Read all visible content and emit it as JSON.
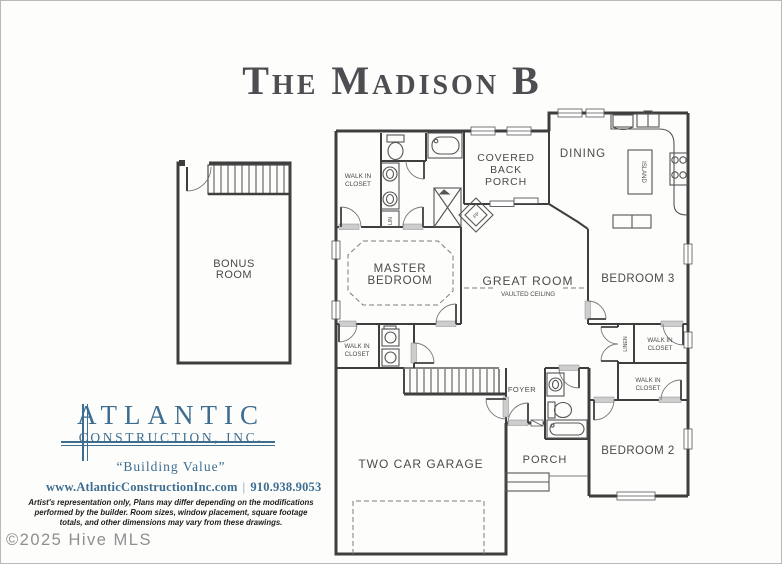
{
  "title": "The Madison B",
  "rooms": {
    "bonus_l1": "BONUS",
    "bonus_l2": "ROOM",
    "wic_master_top_l1": "WALK IN",
    "wic_master_top_l2": "CLOSET",
    "lin": "LIN",
    "covered_porch_l1": "COVERED",
    "covered_porch_l2": "BACK",
    "covered_porch_l3": "PORCH",
    "dining": "DINING",
    "island": "ISLAND",
    "fireplace": "FP",
    "master_l1": "MASTER",
    "master_l2": "BEDROOM",
    "great_room": "GREAT ROOM",
    "vaulted": "VAULTED CEILING",
    "bedroom3": "BEDROOM 3",
    "linen": "LINEN",
    "wic_bed3_l1": "WALK IN",
    "wic_bed3_l2": "CLOSET",
    "wic_master_bot_l1": "WALK IN",
    "wic_master_bot_l2": "CLOSET",
    "wic_bed2_l1": "WALK IN",
    "wic_bed2_l2": "CLOSET",
    "foyer": "FOYER",
    "bedroom2": "BEDROOM 2",
    "porch": "PORCH",
    "garage": "TWO CAR GARAGE"
  },
  "logo": {
    "name": "ATLANTIC",
    "subtitle": "CONSTRUCTION, INC.",
    "tagline": "“Building Value”",
    "website": "www.AtlanticConstructionInc.com",
    "separator": "|",
    "phone": "910.938.9053",
    "color": "#3d6e91"
  },
  "disclaimer": {
    "line1": "Artist's representation only, Plans may differ depending on the modifications",
    "line2": "performed by the builder.  Room sizes, window placement, square footage",
    "line3": "totals, and other dimensions may vary from these drawings."
  },
  "watermark": "©2025 Hive MLS"
}
